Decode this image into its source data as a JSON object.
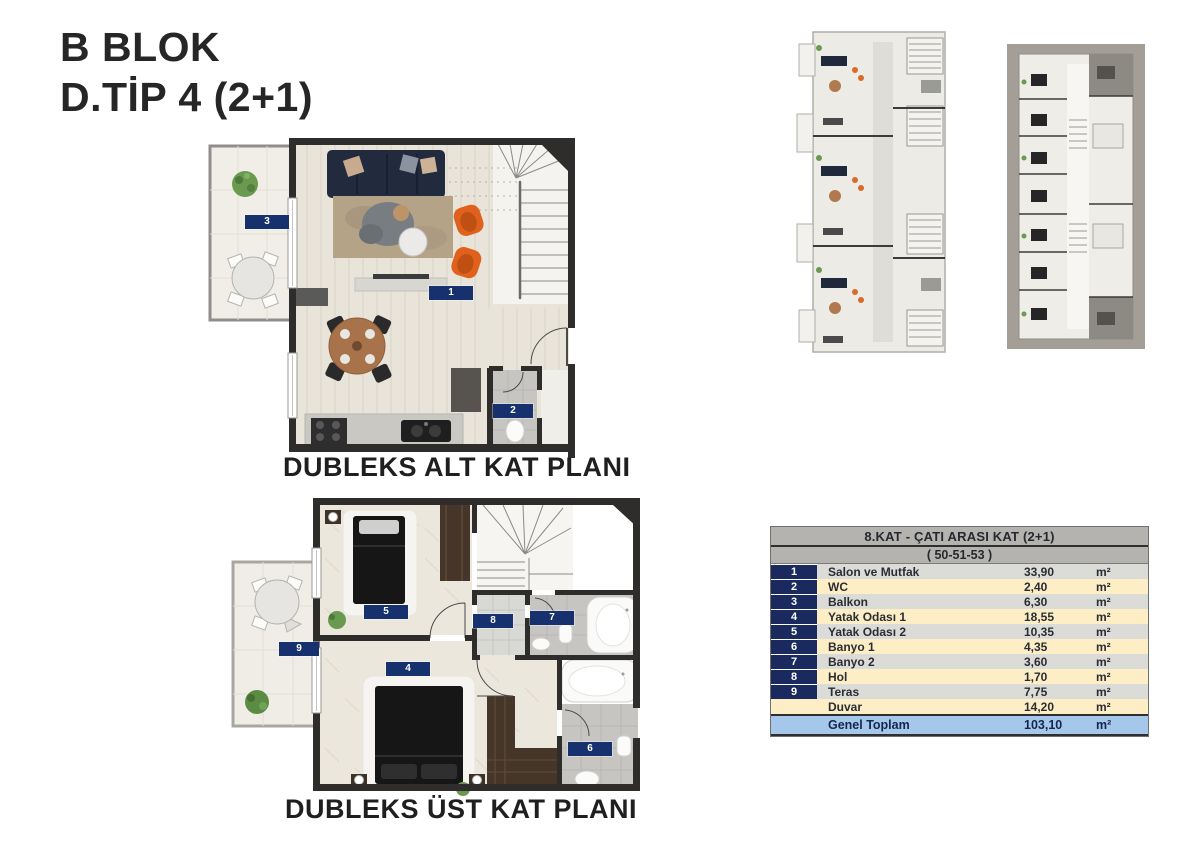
{
  "title": {
    "line1": "B BLOK",
    "line2": "D.TİP 4 (2+1)"
  },
  "plans": {
    "lower": {
      "caption": "DUBLEKS ALT KAT PLANI",
      "badges": {
        "b1": "1",
        "b2": "2",
        "b3": "3"
      }
    },
    "upper": {
      "caption": "DUBLEKS ÜST KAT PLANI",
      "badges": {
        "b4": "4",
        "b5": "5",
        "b6": "6",
        "b7": "7",
        "b8": "8",
        "b9": "9"
      }
    }
  },
  "table": {
    "header": "8.KAT - ÇATI ARASI KAT (2+1)",
    "subheader": "( 50-51-53 )",
    "unit": "m²",
    "rows": [
      {
        "num": "1",
        "label": "Salon ve Mutfak",
        "value": "33,90"
      },
      {
        "num": "2",
        "label": "WC",
        "value": "2,40"
      },
      {
        "num": "3",
        "label": "Balkon",
        "value": "6,30"
      },
      {
        "num": "4",
        "label": "Yatak Odası 1",
        "value": "18,55"
      },
      {
        "num": "5",
        "label": "Yatak Odası 2",
        "value": "10,35"
      },
      {
        "num": "6",
        "label": "Banyo 1",
        "value": "4,35"
      },
      {
        "num": "7",
        "label": "Banyo 2",
        "value": "3,60"
      },
      {
        "num": "8",
        "label": "Hol",
        "value": "1,70"
      },
      {
        "num": "9",
        "label": "Teras",
        "value": "7,75"
      },
      {
        "num": "",
        "label": "Duvar",
        "value": "14,20"
      }
    ],
    "total": {
      "label": "Genel Toplam",
      "value": "103,10"
    }
  },
  "colors": {
    "badge_navy": "#16316e",
    "table_num_navy": "#1b2a5e",
    "header_gray": "#b4b3b0",
    "row_gray": "#dbdbd8",
    "row_yellow": "#fdeec6",
    "total_blue": "#a5c8ea",
    "accent_orange": "#e0611c",
    "wall_dark": "#2e2d2b"
  }
}
